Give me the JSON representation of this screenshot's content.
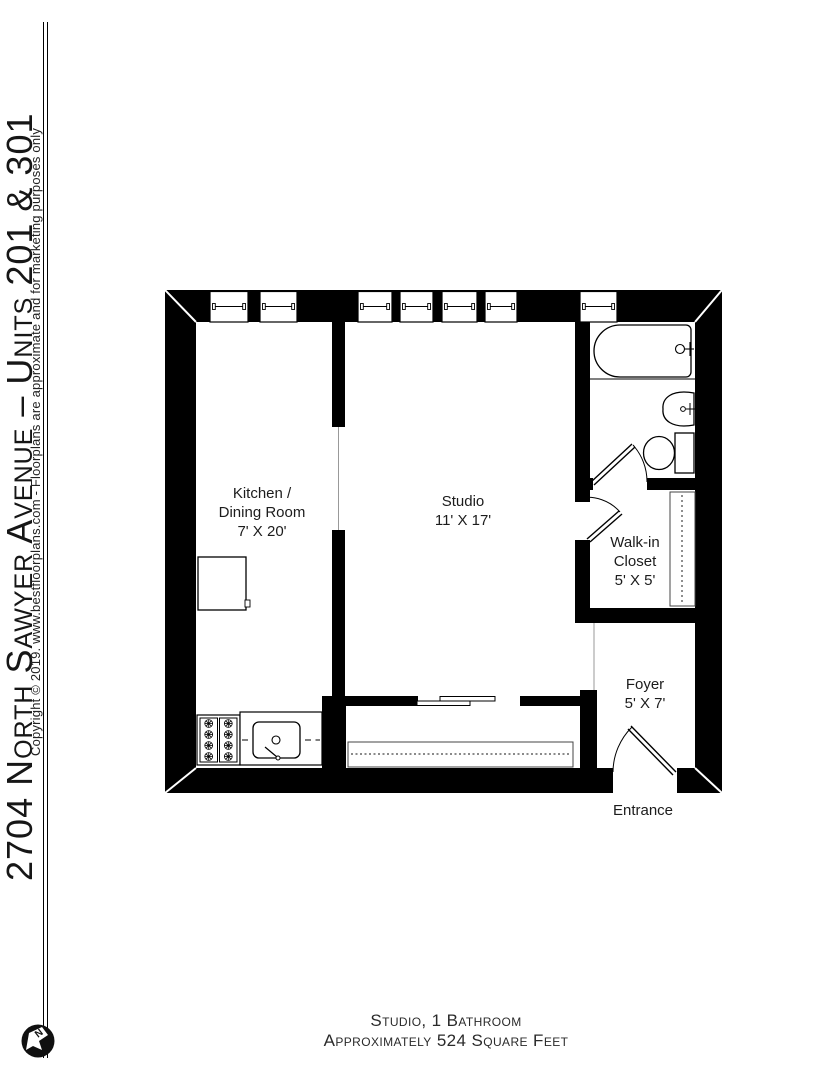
{
  "sidebar": {
    "title": "2704 North Sawyer Avenue – Units 201 & 301",
    "copyright": "Copyright © 2019. www.bestfloorplans.com - Floorplans are approximate and for marketing purposes only",
    "compass_label": "N"
  },
  "plan": {
    "rooms": [
      {
        "id": "kitchen-dining",
        "lines": [
          "Kitchen /",
          "Dining Room",
          "7' X 20'"
        ]
      },
      {
        "id": "studio",
        "lines": [
          "Studio",
          "11' X 17'"
        ]
      },
      {
        "id": "walk-in-closet",
        "lines": [
          "Walk-in",
          "Closet",
          "5' X 5'"
        ]
      },
      {
        "id": "foyer",
        "lines": [
          "Foyer",
          "5' X 7'"
        ]
      }
    ],
    "entrance_label": "Entrance",
    "window_count": 7,
    "fixtures": [
      "bathtub",
      "bathroom-sink",
      "toilet",
      "refrigerator",
      "range",
      "kitchen-sink",
      "counter",
      "closet-rod",
      "closet-shelf",
      "sliding-closet-doors"
    ],
    "wall_color": "#000000"
  },
  "footer": {
    "line1": "Studio, 1 Bathroom",
    "line2": "Approximately 524 Square Feet"
  }
}
